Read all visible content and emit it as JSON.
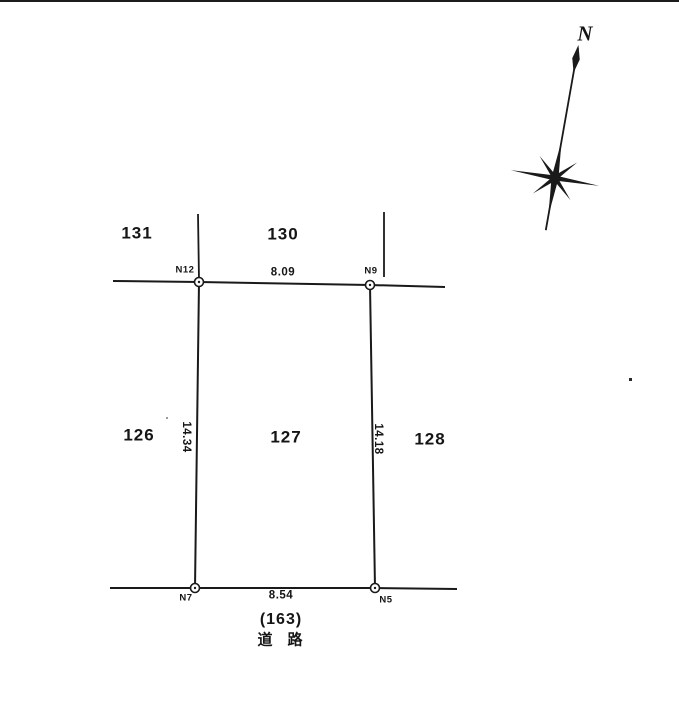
{
  "diagram": {
    "title_hint": "land-survey-parcel-plot",
    "compass": {
      "north_label": "N"
    },
    "lots": {
      "lot_131": "131",
      "lot_130": "130",
      "lot_126": "126",
      "lot_127": "127",
      "lot_128": "128"
    },
    "points": {
      "n12": "N12",
      "n9": "N9",
      "n7": "N7",
      "n5": "N5"
    },
    "dimensions": {
      "top": "8.09",
      "bottom": "8.54",
      "left": "14.34",
      "right": "14.18"
    },
    "road": {
      "number": "(163)",
      "label": "道　路"
    },
    "colors": {
      "ink": "#1a1a1a",
      "paper": "#ffffff"
    }
  }
}
